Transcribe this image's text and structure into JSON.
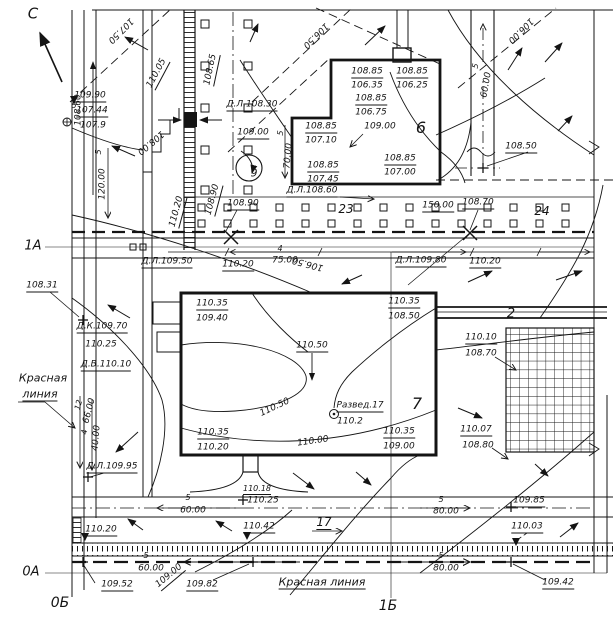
{
  "meta": {
    "drawing_kind": "site grading / vertical planning plan"
  },
  "colors": {
    "ink": "#141414",
    "paper": "#ffffff"
  },
  "plan": {
    "north_mark": "С",
    "axis_marks": {
      "horizontal": [
        "1А",
        "0А"
      ],
      "vertical": [
        "0Б",
        "1Б"
      ]
    },
    "building_numbers": [
      "6",
      "7"
    ],
    "road_numbers": [
      "2",
      "9"
    ],
    "tree_group_numbers": [
      "23",
      "24",
      "17"
    ],
    "red_line_text": "Красная линия",
    "survey_point": {
      "label": "Развед.17",
      "elevation": "110.2"
    }
  },
  "labels": [
    {
      "t": "С",
      "x": 33,
      "y": 14,
      "fs": 15,
      "n": "north-letter"
    },
    {
      "t": "107.50",
      "x": 120,
      "y": 30,
      "r": 135,
      "n": "contour-label"
    },
    {
      "t": "106.50",
      "x": 315,
      "y": 35,
      "r": 135,
      "n": "contour-label"
    },
    {
      "t": "106.00",
      "x": 520,
      "y": 30,
      "r": 135,
      "n": "contour-label"
    },
    {
      "t": "110.05",
      "x": 158,
      "y": 74,
      "r": -62,
      "u": 1,
      "n": "elevation-label"
    },
    {
      "t": "108.65",
      "x": 212,
      "y": 70,
      "r": -78,
      "u": 1,
      "n": "elevation-label"
    },
    {
      "t": "109.90",
      "x": 90,
      "y": 97,
      "u": 1,
      "n": "elevation-label"
    },
    {
      "t": "107.44",
      "x": 92,
      "y": 112,
      "u": 1,
      "n": "elevation-label"
    },
    {
      "t": "107.9",
      "x": 93,
      "y": 126,
      "n": "elevation-label"
    },
    {
      "t": "5",
      "x": 74,
      "y": 106,
      "fs": 8,
      "n": "dim-label"
    },
    {
      "t": "108.60",
      "x": 79,
      "y": 110,
      "r": -90,
      "n": "elevation-label"
    },
    {
      "t": "5",
      "x": 99,
      "y": 152,
      "r": -90,
      "fs": 8,
      "n": "slope-label"
    },
    {
      "t": "120.00",
      "x": 103,
      "y": 184,
      "r": -90,
      "n": "dim-label"
    },
    {
      "t": "108.00",
      "x": 150,
      "y": 142,
      "r": 140,
      "n": "contour-label"
    },
    {
      "t": "110.20",
      "x": 178,
      "y": 212,
      "r": -75,
      "u": 1,
      "n": "elevation-label"
    },
    {
      "t": "108.90",
      "x": 214,
      "y": 200,
      "r": -75,
      "u": 1,
      "n": "elevation-label"
    },
    {
      "t": "Д.Л.108.30",
      "x": 252,
      "y": 106,
      "u": 1,
      "n": "elevation-label"
    },
    {
      "t": "109.00",
      "x": 253,
      "y": 134,
      "u": 1,
      "n": "elevation-label"
    },
    {
      "t": "5",
      "x": 281,
      "y": 133,
      "r": -85,
      "fs": 8,
      "n": "slope-label"
    },
    {
      "t": "70.00",
      "x": 289,
      "y": 156,
      "r": -85,
      "n": "dim-label"
    },
    {
      "t": "9",
      "x": 254,
      "y": 173,
      "fs": 11,
      "n": "road-number"
    },
    {
      "t": "Д.Л.108.60",
      "x": 312,
      "y": 192,
      "u": 1,
      "n": "elevation-label"
    },
    {
      "t": "108.90",
      "x": 243,
      "y": 205,
      "u": 1,
      "n": "elevation-label"
    },
    {
      "t": "23",
      "x": 346,
      "y": 209,
      "fs": 12,
      "n": "tree-group-number"
    },
    {
      "t": "150.00",
      "x": 438,
      "y": 207,
      "u": 1,
      "n": "dim-label"
    },
    {
      "t": "108.70",
      "x": 478,
      "y": 204,
      "u": 1,
      "n": "elevation-label"
    },
    {
      "t": "24",
      "x": 542,
      "y": 211,
      "fs": 12,
      "n": "tree-group-number"
    },
    {
      "t": "108.85",
      "x": 367,
      "y": 73,
      "u": 1,
      "n": "elevation-label"
    },
    {
      "t": "106.35",
      "x": 367,
      "y": 86,
      "n": "elevation-label"
    },
    {
      "t": "108.85",
      "x": 412,
      "y": 73,
      "u": 1,
      "n": "elevation-label"
    },
    {
      "t": "106.25",
      "x": 412,
      "y": 86,
      "n": "elevation-label"
    },
    {
      "t": "108.85",
      "x": 371,
      "y": 100,
      "u": 1,
      "n": "elevation-label"
    },
    {
      "t": "106.75",
      "x": 371,
      "y": 113,
      "n": "elevation-label"
    },
    {
      "t": "109.00",
      "x": 380,
      "y": 127,
      "n": "elevation-label"
    },
    {
      "t": "108.85",
      "x": 321,
      "y": 128,
      "u": 1,
      "n": "elevation-label"
    },
    {
      "t": "107.10",
      "x": 321,
      "y": 141,
      "n": "elevation-label"
    },
    {
      "t": "108.85",
      "x": 323,
      "y": 167,
      "u": 1,
      "n": "elevation-label"
    },
    {
      "t": "107.45",
      "x": 323,
      "y": 180,
      "n": "elevation-label"
    },
    {
      "t": "108.85",
      "x": 400,
      "y": 160,
      "u": 1,
      "n": "elevation-label"
    },
    {
      "t": "107.00",
      "x": 400,
      "y": 173,
      "n": "elevation-label"
    },
    {
      "t": "6",
      "x": 421,
      "y": 128,
      "fs": 16,
      "n": "building-number"
    },
    {
      "t": "5",
      "x": 476,
      "y": 66,
      "r": -80,
      "fs": 8,
      "n": "slope-label"
    },
    {
      "t": "60.00",
      "x": 487,
      "y": 85,
      "r": -80,
      "n": "dim-label"
    },
    {
      "t": "108.50",
      "x": 521,
      "y": 148,
      "u": 1,
      "n": "elevation-label"
    },
    {
      "t": "Д.Л.109.50",
      "x": 167,
      "y": 263,
      "u": 1,
      "n": "elevation-label"
    },
    {
      "t": "110.20",
      "x": 238,
      "y": 266,
      "u": 1,
      "n": "elevation-label"
    },
    {
      "t": "4",
      "x": 280,
      "y": 249,
      "fs": 8,
      "n": "slope-label"
    },
    {
      "t": "75.00",
      "x": 285,
      "y": 261,
      "n": "dim-label"
    },
    {
      "t": "106.50",
      "x": 308,
      "y": 263,
      "r": 195,
      "n": "contour-label"
    },
    {
      "t": "Д.Л.109.80",
      "x": 421,
      "y": 262,
      "u": 1,
      "n": "elevation-label"
    },
    {
      "t": "110.20",
      "x": 485,
      "y": 263,
      "u": 1,
      "n": "elevation-label"
    },
    {
      "t": "108.31",
      "x": 42,
      "y": 287,
      "u": 1,
      "n": "elevation-label"
    },
    {
      "t": "Д.К.109.70",
      "x": 102,
      "y": 328,
      "u": 1,
      "n": "elevation-label"
    },
    {
      "t": "110.25",
      "x": 101,
      "y": 345,
      "n": "elevation-label"
    },
    {
      "t": "Д.В.110.10",
      "x": 106,
      "y": 366,
      "u": 1,
      "n": "elevation-label"
    },
    {
      "t": "Красная",
      "x": 43,
      "y": 378,
      "fs": 11,
      "n": "red-line-label"
    },
    {
      "t": "линия",
      "x": 40,
      "y": 395,
      "fs": 11,
      "u": 1,
      "n": "red-line-label"
    },
    {
      "t": "110.35",
      "x": 212,
      "y": 305,
      "u": 1,
      "n": "elevation-label"
    },
    {
      "t": "109.40",
      "x": 212,
      "y": 319,
      "n": "elevation-label"
    },
    {
      "t": "110.35",
      "x": 404,
      "y": 303,
      "u": 1,
      "n": "elevation-label"
    },
    {
      "t": "108.50",
      "x": 404,
      "y": 317,
      "n": "elevation-label"
    },
    {
      "t": "110.50",
      "x": 312,
      "y": 347,
      "u": 1,
      "n": "contour-callout"
    },
    {
      "t": "110.50",
      "x": 275,
      "y": 408,
      "r": -25,
      "n": "contour-label"
    },
    {
      "t": "Развед.17",
      "x": 360,
      "y": 407,
      "u": 1,
      "n": "survey-point-label"
    },
    {
      "t": "110.2",
      "x": 350,
      "y": 422,
      "n": "survey-point-elevation"
    },
    {
      "t": "7",
      "x": 417,
      "y": 404,
      "fs": 16,
      "n": "building-number"
    },
    {
      "t": "110.35",
      "x": 213,
      "y": 434,
      "u": 1,
      "n": "elevation-label"
    },
    {
      "t": "110.20",
      "x": 213,
      "y": 448,
      "n": "elevation-label"
    },
    {
      "t": "110.35",
      "x": 399,
      "y": 433,
      "u": 1,
      "n": "elevation-label"
    },
    {
      "t": "109.00",
      "x": 399,
      "y": 447,
      "n": "elevation-label"
    },
    {
      "t": "110.00",
      "x": 313,
      "y": 442,
      "r": -8,
      "n": "contour-label"
    },
    {
      "t": "2",
      "x": 511,
      "y": 314,
      "fs": 13,
      "n": "road-number"
    },
    {
      "t": "110.10",
      "x": 481,
      "y": 339,
      "u": 1,
      "n": "elevation-label"
    },
    {
      "t": "108.70",
      "x": 481,
      "y": 354,
      "n": "elevation-label"
    },
    {
      "t": "110.07",
      "x": 476,
      "y": 431,
      "u": 1,
      "n": "elevation-label"
    },
    {
      "t": "108.80",
      "x": 478,
      "y": 446,
      "n": "elevation-label"
    },
    {
      "t": "12",
      "x": 79,
      "y": 405,
      "r": -75,
      "fs": 8,
      "n": "dim-label"
    },
    {
      "t": "66.00",
      "x": 90,
      "y": 411,
      "r": -75,
      "n": "dim-label"
    },
    {
      "t": "4",
      "x": 85,
      "y": 432,
      "r": -85,
      "fs": 8,
      "n": "dim-label"
    },
    {
      "t": "40.00",
      "x": 97,
      "y": 438,
      "r": -85,
      "n": "dim-label"
    },
    {
      "t": "Д.Л.109.95",
      "x": 112,
      "y": 468,
      "u": 1,
      "n": "elevation-label"
    },
    {
      "t": "110.18",
      "x": 257,
      "y": 490,
      "fs": 8,
      "u": 1,
      "n": "elevation-label"
    },
    {
      "t": "110.25",
      "x": 263,
      "y": 501,
      "n": "elevation-label"
    },
    {
      "t": "5",
      "x": 188,
      "y": 498,
      "fs": 8,
      "n": "slope-label"
    },
    {
      "t": "60.00",
      "x": 193,
      "y": 511,
      "n": "dim-label"
    },
    {
      "t": "110.20",
      "x": 101,
      "y": 531,
      "u": 1,
      "n": "elevation-label"
    },
    {
      "t": "110.42",
      "x": 259,
      "y": 528,
      "u": 1,
      "n": "elevation-label"
    },
    {
      "t": "17",
      "x": 324,
      "y": 523,
      "fs": 12,
      "u": 1,
      "n": "tree-group-number"
    },
    {
      "t": "5",
      "x": 441,
      "y": 500,
      "fs": 8,
      "n": "slope-label"
    },
    {
      "t": "80.00",
      "x": 446,
      "y": 512,
      "n": "dim-label"
    },
    {
      "t": "109.85",
      "x": 529,
      "y": 502,
      "u": 1,
      "n": "elevation-label"
    },
    {
      "t": "110.03",
      "x": 527,
      "y": 528,
      "u": 1,
      "n": "elevation-label"
    },
    {
      "t": "5",
      "x": 146,
      "y": 556,
      "fs": 8,
      "n": "slope-label"
    },
    {
      "t": "60.00",
      "x": 151,
      "y": 569,
      "n": "dim-label"
    },
    {
      "t": "109.52",
      "x": 117,
      "y": 586,
      "u": 1,
      "n": "elevation-label"
    },
    {
      "t": "109.00",
      "x": 170,
      "y": 577,
      "r": -40,
      "u": 1,
      "n": "elevation-label"
    },
    {
      "t": "109.82",
      "x": 202,
      "y": 586,
      "u": 1,
      "n": "elevation-label"
    },
    {
      "t": "Красная линия",
      "x": 322,
      "y": 583,
      "fs": 11,
      "u": 1,
      "n": "red-line-label"
    },
    {
      "t": "5",
      "x": 441,
      "y": 556,
      "fs": 8,
      "n": "slope-label"
    },
    {
      "t": "80.00",
      "x": 446,
      "y": 569,
      "n": "dim-label"
    },
    {
      "t": "109.42",
      "x": 558,
      "y": 584,
      "u": 1,
      "n": "elevation-label"
    },
    {
      "t": "1А",
      "x": 33,
      "y": 246,
      "fs": 13,
      "n": "axis-label-1a"
    },
    {
      "t": "0А",
      "x": 31,
      "y": 572,
      "fs": 13,
      "n": "axis-label-0a"
    },
    {
      "t": "0Б",
      "x": 60,
      "y": 603,
      "fs": 14,
      "n": "axis-label-0b"
    },
    {
      "t": "1Б",
      "x": 388,
      "y": 606,
      "fs": 14,
      "n": "axis-label-1b"
    }
  ]
}
